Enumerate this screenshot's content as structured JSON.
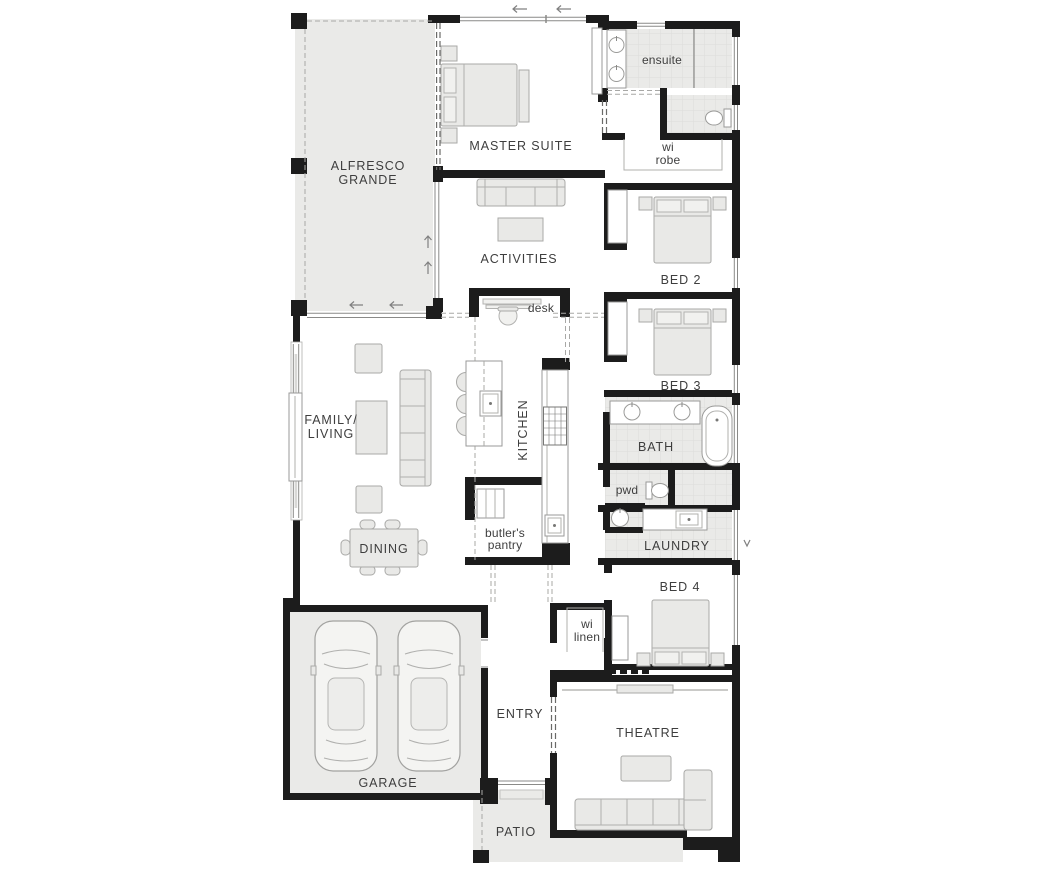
{
  "plan_title": "single storey home floor plan",
  "colors": {
    "wall": "#1c1c1c",
    "slab": "#eaeae8",
    "tile_grid": "#dedddb",
    "furniture": "#e9e9e7",
    "label_text": "#3e3e3e"
  },
  "rooms": {
    "alfresco": {
      "line1": "ALFRESCO",
      "line2": "GRANDE"
    },
    "master": {
      "label": "MASTER SUITE"
    },
    "ensuite": {
      "label": "ensuite"
    },
    "wi_robe": {
      "line1": "wi",
      "line2": "robe"
    },
    "activities": {
      "label": "ACTIVITIES"
    },
    "desk": {
      "label": "desk"
    },
    "bed2": {
      "label": "BED 2"
    },
    "bed3": {
      "label": "BED 3"
    },
    "family_living": {
      "line1": "FAMILY/",
      "line2": "LIVING"
    },
    "kitchen": {
      "label": "KITCHEN"
    },
    "bath": {
      "label": "BATH"
    },
    "pwd": {
      "label": "pwd"
    },
    "butlers_pantry": {
      "line1": "butler's",
      "line2": "pantry"
    },
    "laundry": {
      "label": "LAUNDRY"
    },
    "dining": {
      "label": "DINING"
    },
    "bed4": {
      "label": "BED 4"
    },
    "wi_linen": {
      "line1": "wi",
      "line2": "linen"
    },
    "entry": {
      "label": "ENTRY"
    },
    "garage": {
      "label": "GARAGE"
    },
    "theatre": {
      "label": "THEATRE"
    },
    "patio": {
      "label": "PATIO"
    }
  }
}
